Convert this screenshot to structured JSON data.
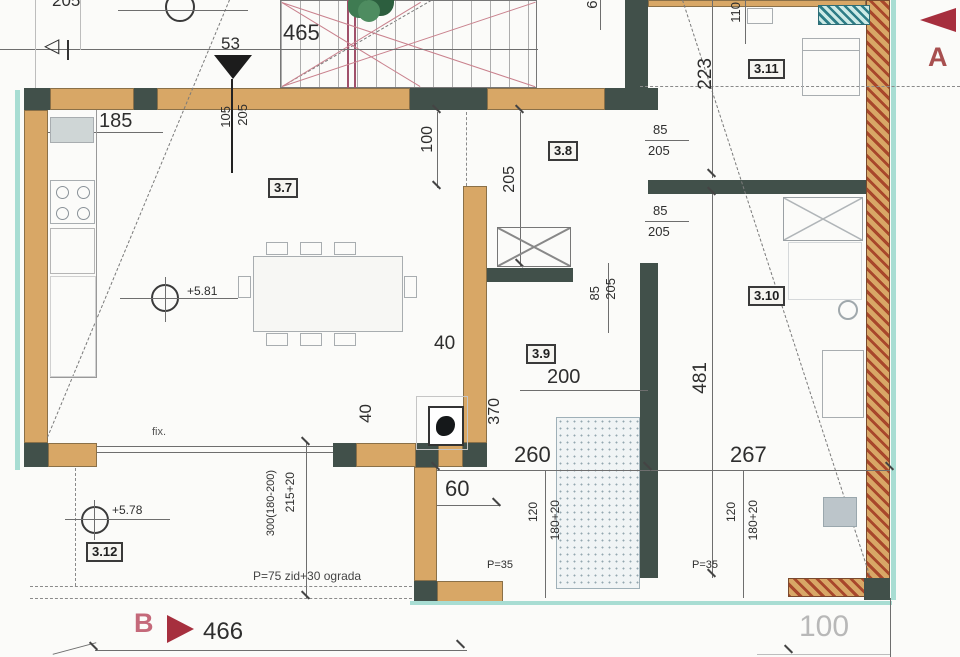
{
  "rooms": {
    "r37": "3.7",
    "r38": "3.8",
    "r39": "3.9",
    "r310": "3.10",
    "r311": "3.11",
    "r312": "3.12"
  },
  "dims": {
    "top205": "205",
    "d53": "53",
    "d465": "465",
    "d185": "185",
    "d105": "105",
    "d105b": "205",
    "d100": "100",
    "d205w": "205",
    "d65": "65",
    "d223": "223",
    "d110": "110",
    "door1_w": "85",
    "door1_h": "205",
    "door2_w": "85",
    "door2_h": "205",
    "door3_w": "85",
    "door3_h": "205",
    "d40a": "40",
    "d200": "200",
    "d481": "481",
    "d40b": "40",
    "d370": "370",
    "d260": "260",
    "d267": "267",
    "d60": "60",
    "d300": "300(180-200)",
    "d215": "215+20",
    "win1_a": "120",
    "win1_b": "180+20",
    "win2_a": "120",
    "win2_b": "180+20",
    "p35a": "P=35",
    "p35b": "P=35",
    "p75": "P=75 zid+30 ograda",
    "d466": "466",
    "d100c": "100"
  },
  "levels": {
    "up": "+5.81",
    "low": "+5.78"
  },
  "notes": {
    "fix": "fix."
  },
  "markers": {
    "a": "A",
    "b": "B"
  },
  "colors": {
    "wall_fill": "#d8a766",
    "wall_dark": "#41504a",
    "brick_red": "#a8472b",
    "teal_edge": "#a8ddd3",
    "section_red": "#a62f3e",
    "letter_pink": "#c4697a",
    "plant_green": "#3f7b52",
    "stair_red": "#c9818d",
    "dim_text": "#2e2e2e",
    "faint_text": "#b8b8b8"
  }
}
